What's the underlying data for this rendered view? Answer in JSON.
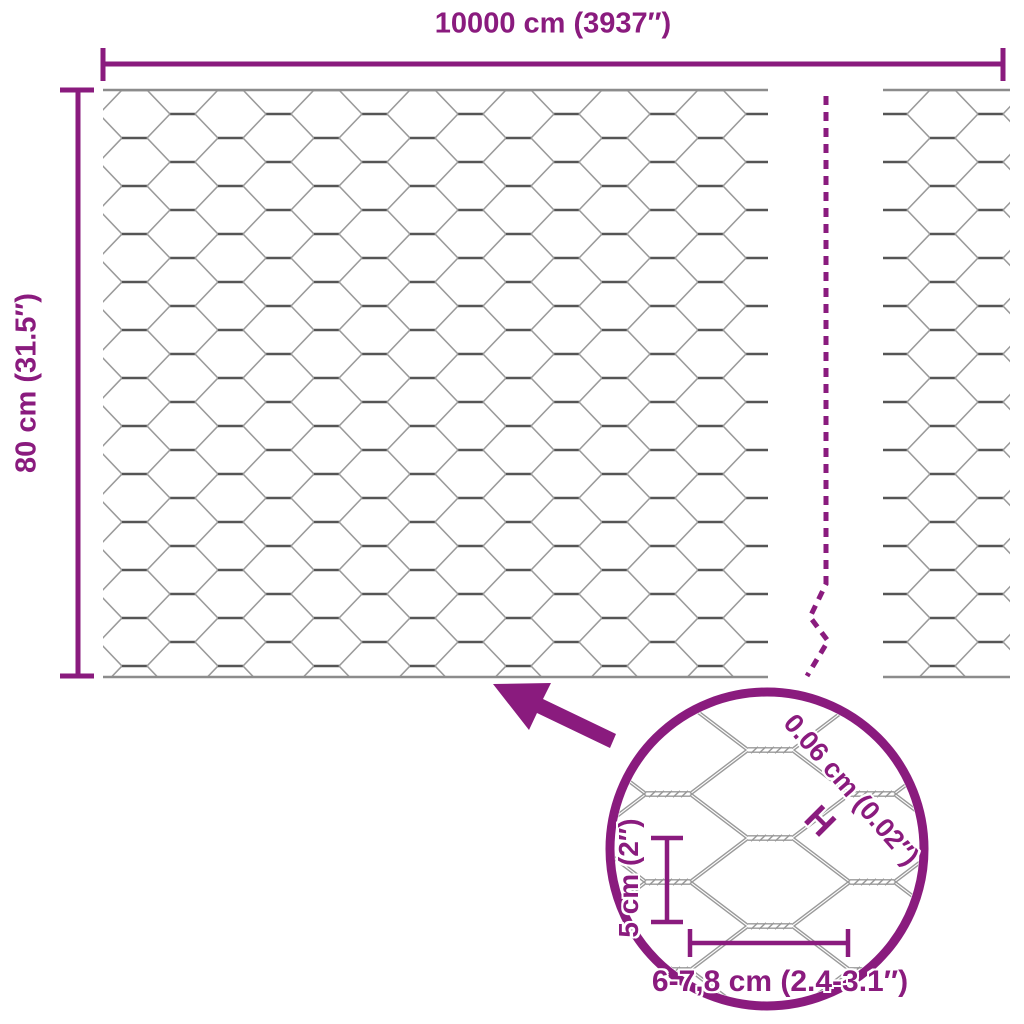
{
  "colors": {
    "accent": "#8A1B7E",
    "wire": "#9a9a9a",
    "wire_dark": "#555555",
    "edge": "#8c8c8c",
    "bg": "#ffffff"
  },
  "dimensions": {
    "width": "10000 cm (3937″)",
    "height": "80 cm (31.5″)"
  },
  "detail": {
    "wire_diameter": "0.06 cm (0.02″)",
    "marker": "H",
    "mesh_size_vertical": "5 cm (2″)",
    "mesh_size_horizontal": "6-7,8 cm (2.4-3.1″)"
  }
}
